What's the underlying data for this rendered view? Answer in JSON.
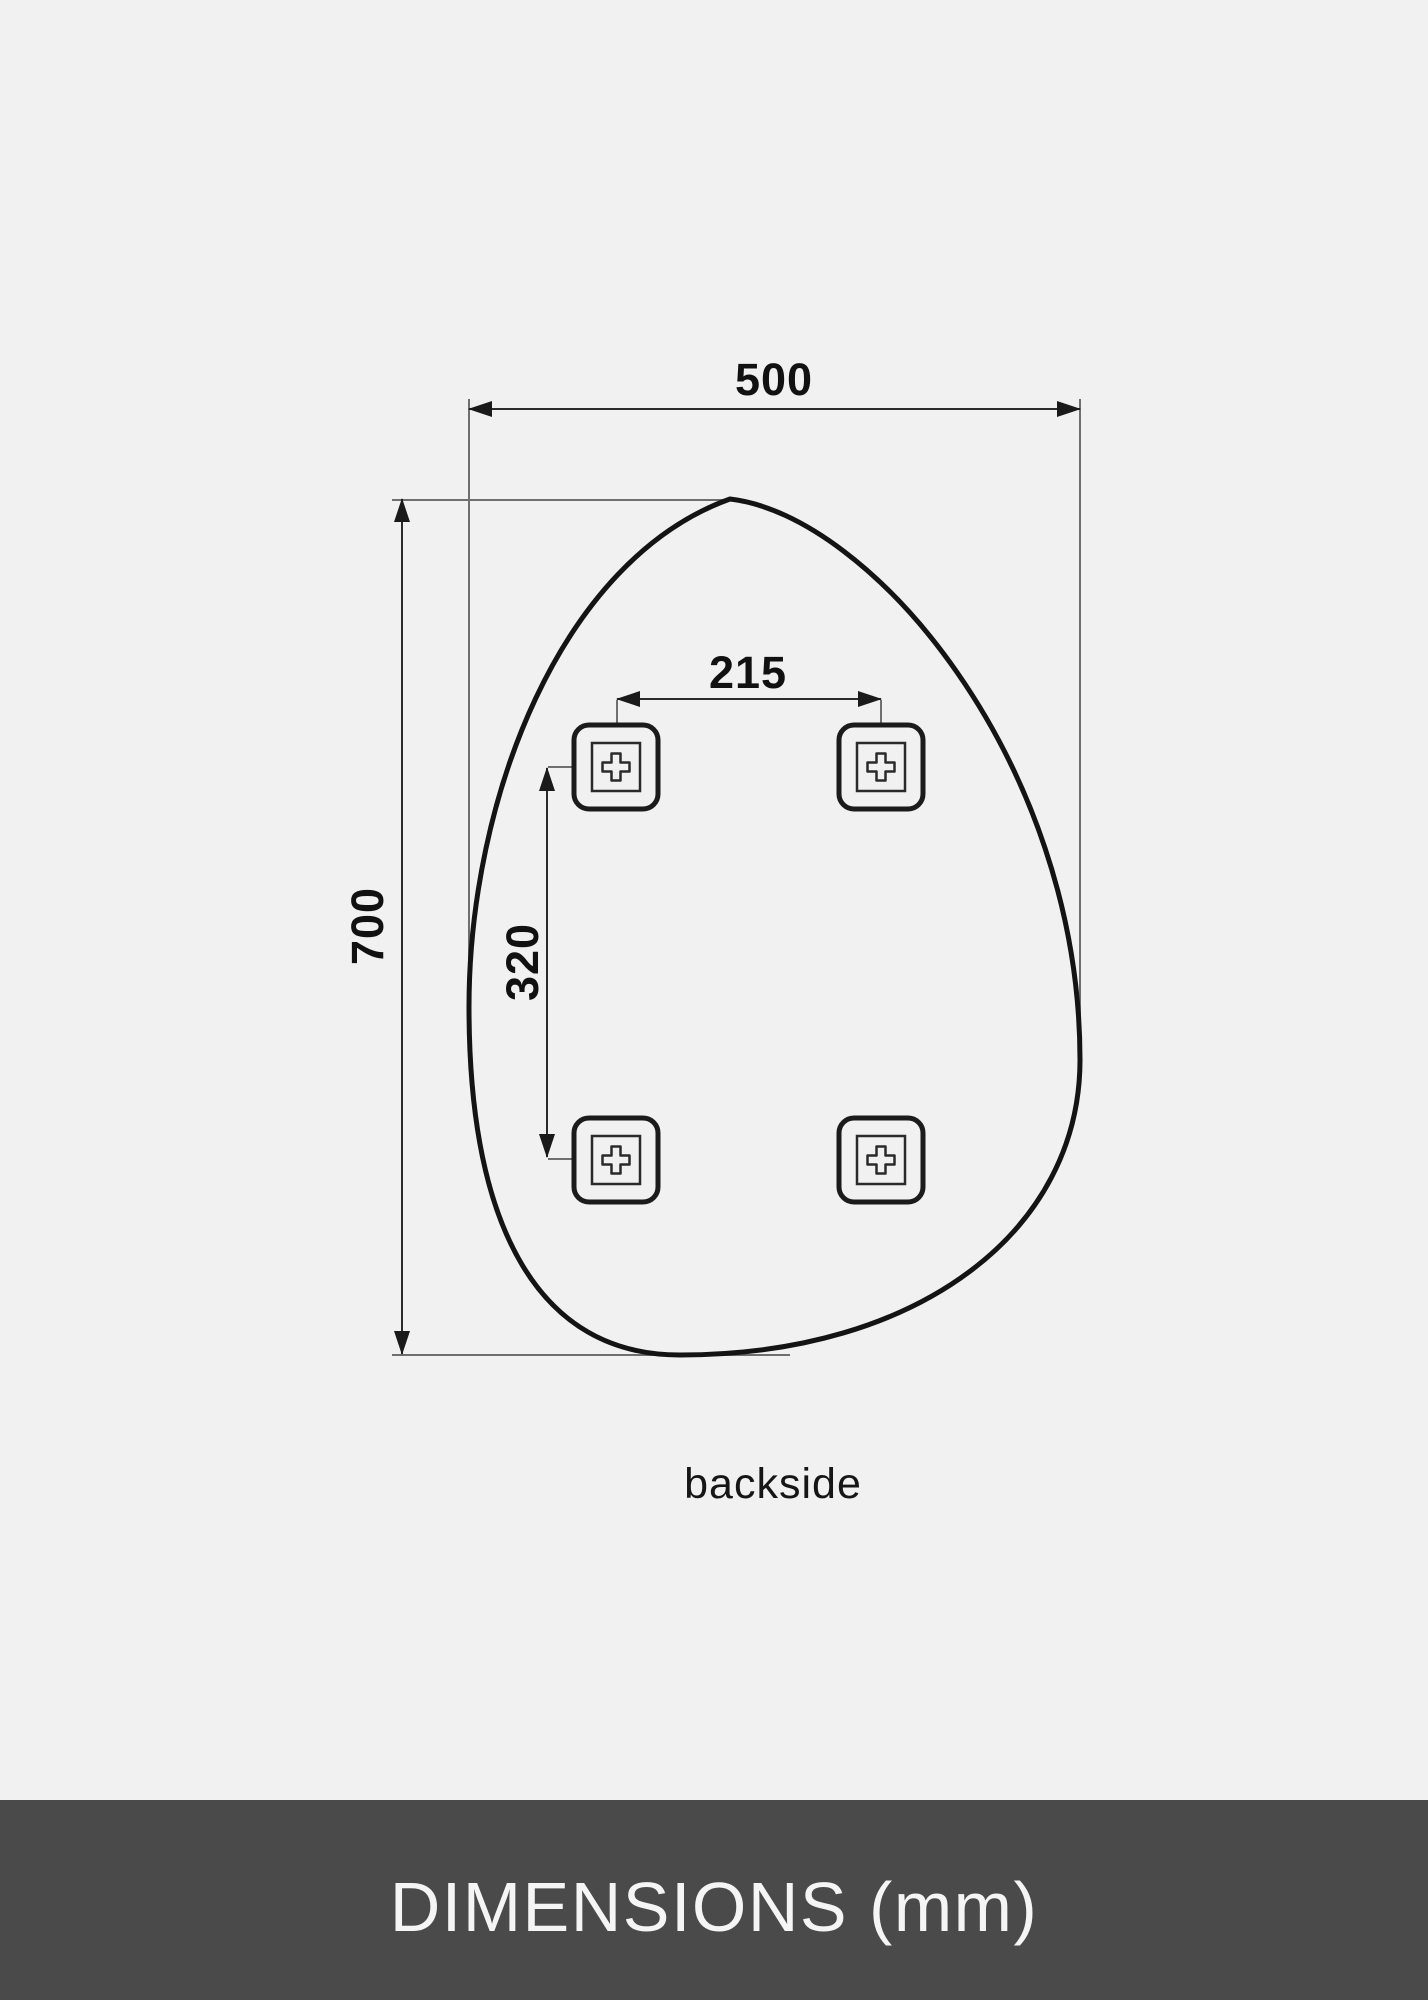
{
  "canvas": {
    "background": "#f1f1f1"
  },
  "diagram": {
    "view_label": "backside",
    "unit": "mm",
    "mirror_width": "500",
    "mirror_height": "700",
    "mount_spacing_horizontal": "215",
    "mount_spacing_vertical": "320",
    "mount_count": 4,
    "colors": {
      "shape_outline": "#141414",
      "dimension_line": "#2b2b2b",
      "extension_line": "#6f6f6f",
      "label_text": "#111111"
    }
  },
  "footer": {
    "title": "DIMENSIONS (mm)",
    "background": "#4a4a4a",
    "text_color": "#f5f5f5"
  }
}
